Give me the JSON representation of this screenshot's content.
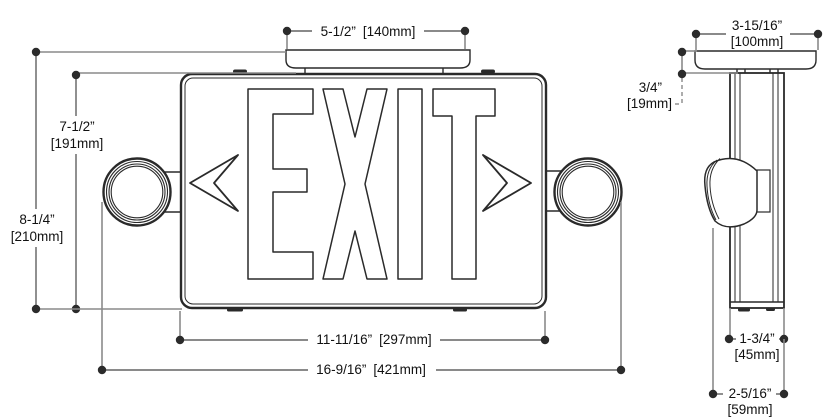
{
  "front_view": {
    "sign_text": "EXIT",
    "arrows": {
      "left": "chevron-left",
      "right": "chevron-right"
    },
    "dims": {
      "canopy_width": {
        "in": "5-1/2”",
        "mm": "[140mm]"
      },
      "sign_height": {
        "in": "7-1/2”",
        "mm": "[191mm]"
      },
      "overall_height": {
        "in": "8-1/4”",
        "mm": "[210mm]"
      },
      "sign_width": {
        "in": "11-11/16”",
        "mm": "[297mm]"
      },
      "overall_width": {
        "in": "16-9/16”",
        "mm": "[421mm]"
      }
    }
  },
  "side_view": {
    "dims": {
      "canopy_width": {
        "in": "3-15/16”",
        "mm": "[100mm]"
      },
      "canopy_height": {
        "in": "3/4”",
        "mm": "[19mm]"
      },
      "body_depth": {
        "in": "1-3/4”",
        "mm": "[45mm]"
      },
      "overall_depth": {
        "in": "2-5/16”",
        "mm": "[59mm]"
      }
    }
  },
  "colors": {
    "line": "#2a2a2a",
    "dimension_line": "#8a8a8a",
    "text": "#111111",
    "background": "#ffffff"
  }
}
